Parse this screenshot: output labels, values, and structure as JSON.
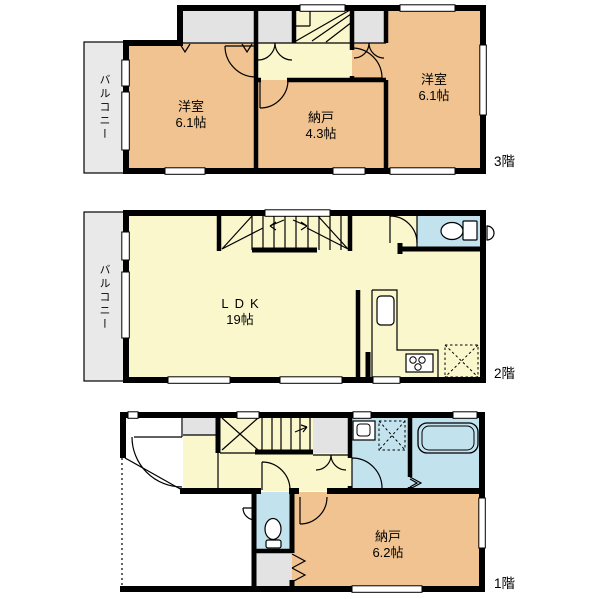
{
  "palette": {
    "room_tan": "#F0C390",
    "hall_yellow": "#FAF7CD",
    "wet_area_blue": "#C2E2EE",
    "closet_gray": "#E3E3E3",
    "balcony_gray": "#E9E9E9",
    "wall_black": "#000000",
    "background": "#FFFFFF"
  },
  "floors": {
    "f3": {
      "label": "3階",
      "balcony_label": "バルコニー",
      "rooms": {
        "west_bedroom": {
          "name": "洋室",
          "size": "6.1帖"
        },
        "storage": {
          "name": "納戸",
          "size": "4.3帖"
        },
        "east_bedroom": {
          "name": "洋室",
          "size": "6.1帖"
        }
      }
    },
    "f2": {
      "label": "2階",
      "balcony_label": "バルコニー",
      "rooms": {
        "ldk": {
          "name": "LDK",
          "size": "19帖"
        }
      }
    },
    "f1": {
      "label": "1階",
      "rooms": {
        "storage": {
          "name": "納戸",
          "size": "6.2帖"
        }
      }
    }
  }
}
